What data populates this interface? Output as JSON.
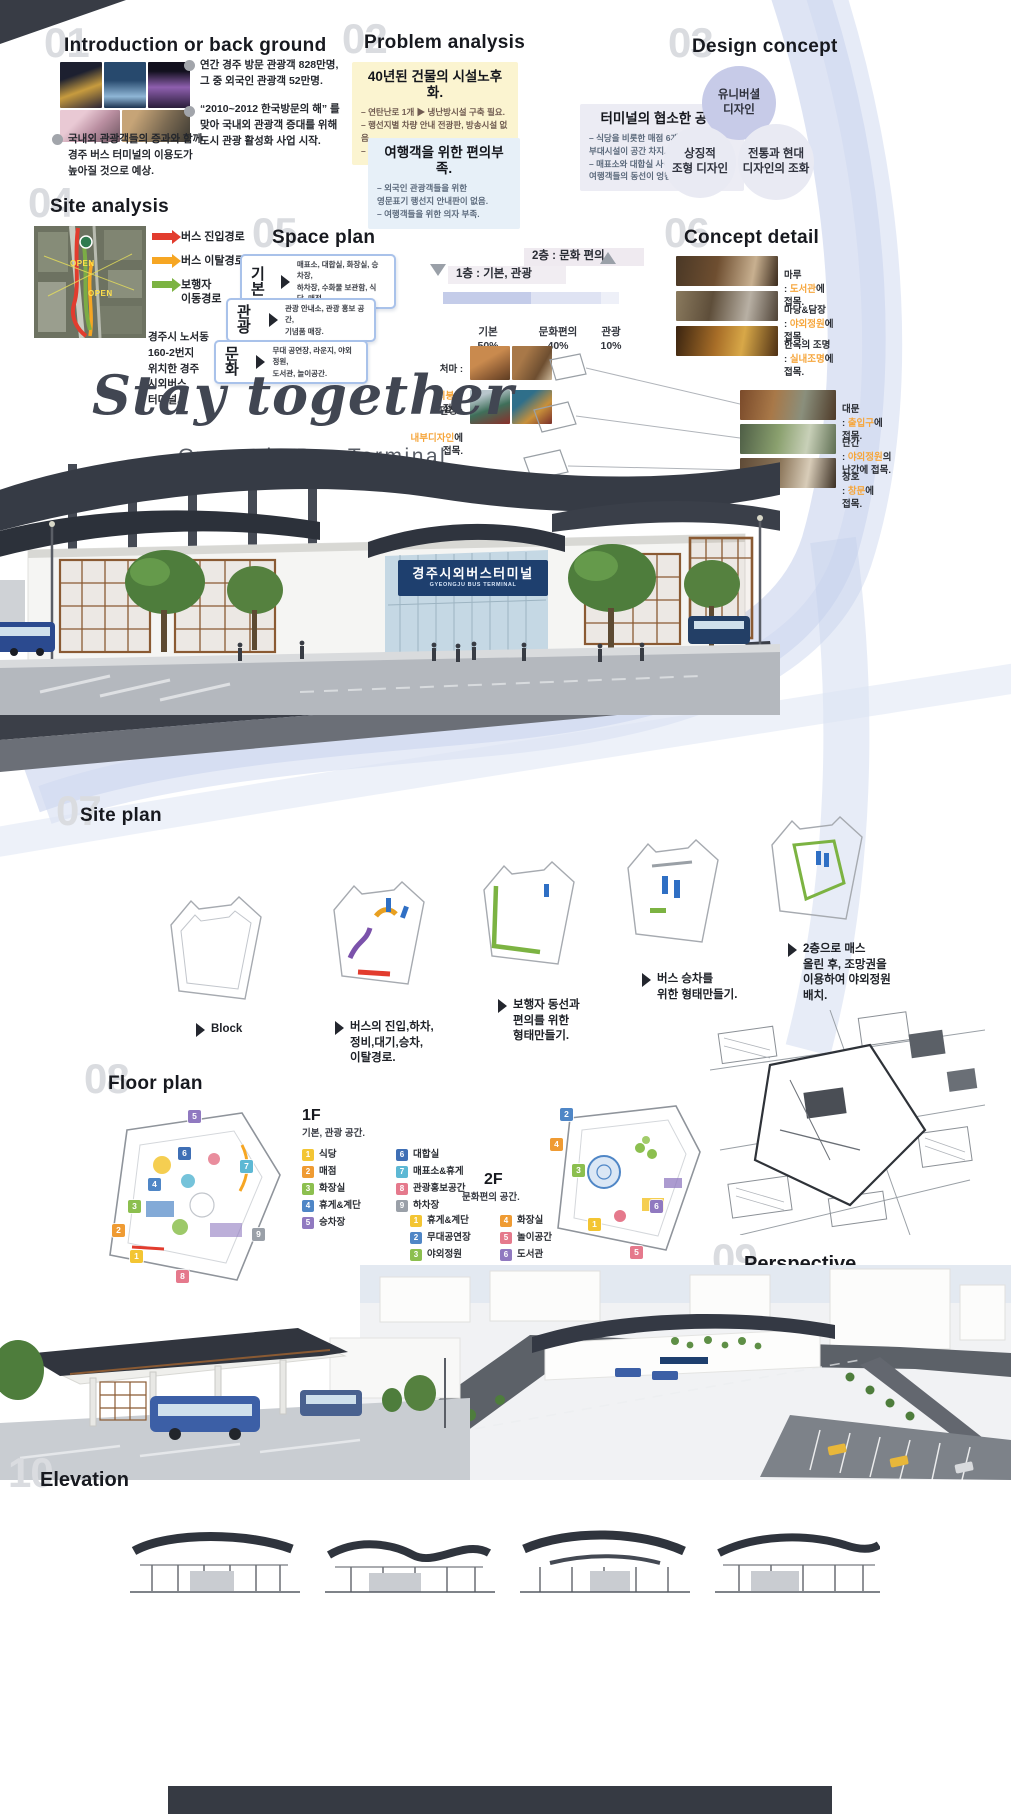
{
  "colors": {
    "hl": "#f6a63c",
    "busin": "#e23c2e",
    "busout": "#f6a623",
    "ped": "#7cb342",
    "sign": "#1e3f6e",
    "navy": "#343944",
    "ribbon": "#b3c2e4",
    "ghost": "#dadce0"
  },
  "s01": {
    "num": "01",
    "title": "Introduction or back ground",
    "notes": [
      "연간 경주 방문 관광객 828만명,\n그 중 외국인 관광객 52만명.",
      "“2010~2012 한국방문의 해” 를\n맞아 국내외 관광객 증대를 위해\n도시 관광 활성화 사업 시작.",
      "국내외 관광객들의 증과와 함께\n경주 버스 터미널의 이용도가\n높아질 것으로 예상."
    ]
  },
  "s02": {
    "num": "02",
    "title": "Problem analysis",
    "boxes": [
      {
        "title": "40년된 건물의 시설노후화.",
        "bullets": [
          "– 연탄난로 1개 ▶ 냉난방시설 구축 필요.",
          "– 행선지별 차량 안내 전광판, 방송시설 없음.",
          "– 방범용 CCTV 없음 ▶ 민생범죄에 취약."
        ]
      },
      {
        "title": "여행객을 위한 편의부족.",
        "bullets": [
          "– 외국인 관광객들을 위한\n   영문표기 행선지 안내판이 없음.",
          "– 여행객들을 위한 의자 부족."
        ]
      },
      {
        "title": "터미널의 협소한 공간.",
        "bullets": [
          "– 식당을 비롯한 매점 6개소와\n   부대시설이 공간 차지.",
          "– 매표소와 대합실 사이\n   여행객들의 동선이 엉킴."
        ]
      }
    ]
  },
  "s03": {
    "num": "03",
    "title": "Design concept",
    "circles": [
      "유니버셜\n디자인",
      "상징적\n조형 디자인",
      "전통과 현대\n디자인의 조화"
    ]
  },
  "s04": {
    "num": "04",
    "title": "Site analysis",
    "legend": [
      {
        "label": "버스 진입경로"
      },
      {
        "label": "버스 이탈경로"
      },
      {
        "label": "보행자\n이동경로"
      }
    ],
    "map_labels": [
      "OPEN",
      "OPEN"
    ],
    "location": "경주시 노서동\n160-2번지\n위치한 경주\n시외버스\n터미널."
  },
  "s05": {
    "num": "05",
    "title": "Space plan",
    "rows": [
      {
        "name": "기본",
        "desc": "매표소, 대합실, 화장실, 승차장,\n하차장, 수화물 보관함, 식당, 매점."
      },
      {
        "name": "관광",
        "desc": "관광 안내소, 관광 홍보 공간,\n기념품 매장."
      },
      {
        "name": "문화",
        "desc": "무대 공연장, 라운지, 야외정원,\n도서관, 놀이공간."
      }
    ],
    "diagram": {
      "floor1": "1층 : 기본, 관광",
      "floor2": "2층 : 문화 편의",
      "segments": [
        {
          "label": "기본",
          "pct": "50%"
        },
        {
          "label": "문화편의",
          "pct": "40%"
        },
        {
          "label": "관광",
          "pct": "10%"
        }
      ]
    },
    "notes": [
      {
        "term": "처마 :",
        "link": "지붕",
        "tail": "에\n접목."
      },
      {
        "term": "단청 :",
        "link": "내부디자인",
        "tail": "에\n접목."
      }
    ]
  },
  "s06": {
    "num": "06",
    "title": "Concept detail",
    "items": [
      {
        "term": "마루",
        "prefix": ": ",
        "link": "도서관",
        "tail": "에\n접목."
      },
      {
        "term": "마당&담장",
        "prefix": ": ",
        "link": "야외정원",
        "tail": "에\n접목."
      },
      {
        "term": "한옥의 조명",
        "prefix": ": ",
        "link": "실내조명",
        "tail": "에\n접목."
      },
      {
        "term": "대문",
        "prefix": ": ",
        "link": "출입구",
        "tail": "에\n접목."
      },
      {
        "term": "난간",
        "prefix": ": ",
        "link": "야외정원",
        "tail": "의\n난간에 접목."
      },
      {
        "term": "창호",
        "prefix": ": ",
        "link": "창문",
        "tail": "에\n접목."
      }
    ]
  },
  "hero": {
    "title": "Stay together",
    "subtitle": "Gyeongju Bus Terminal",
    "sign_ko": "경주시외버스터미널",
    "sign_en": "GYEONGJU BUS TERMINAL"
  },
  "s07": {
    "num": "07",
    "title": "Site plan",
    "steps": [
      {
        "caption": "Block"
      },
      {
        "caption": "버스의 진입,하차,\n정비,대기,승차,\n이탈경로."
      },
      {
        "caption": "보행자 동선과\n편의를 위한\n형태만들기."
      },
      {
        "caption": "버스 승차를\n위한 형태만들기."
      },
      {
        "caption": "2층으로 매스\n올린 후, 조망권을\n이용하여 야외정원\n배치."
      }
    ]
  },
  "s08": {
    "num": "08",
    "title": "Floor plan",
    "f1": {
      "label": "1F",
      "subtitle": "기본, 관광 공간.",
      "items": [
        {
          "n": "1",
          "label": "식당",
          "color": "#f3c533"
        },
        {
          "n": "2",
          "label": "매점",
          "color": "#ef9b33"
        },
        {
          "n": "3",
          "label": "화장실",
          "color": "#8cbf4f"
        },
        {
          "n": "4",
          "label": "휴게&계단",
          "color": "#4f86c6"
        },
        {
          "n": "5",
          "label": "승차장",
          "color": "#9079c0"
        },
        {
          "n": "6",
          "label": "대합실",
          "color": "#3f6fb5"
        },
        {
          "n": "7",
          "label": "매표소&휴게",
          "color": "#5db8d4"
        },
        {
          "n": "8",
          "label": "관광홍보공간",
          "color": "#e5798c"
        },
        {
          "n": "9",
          "label": "하차장",
          "color": "#9aa0a8"
        }
      ]
    },
    "f2": {
      "label": "2F",
      "subtitle": "문화편의 공간.",
      "items": [
        {
          "n": "1",
          "label": "휴게&계단",
          "color": "#f3c533"
        },
        {
          "n": "2",
          "label": "무대공연장",
          "color": "#4f86c6"
        },
        {
          "n": "3",
          "label": "야외정원",
          "color": "#8cbf4f"
        },
        {
          "n": "4",
          "label": "화장실",
          "color": "#ef9b33"
        },
        {
          "n": "5",
          "label": "놀이공간",
          "color": "#e5798c"
        },
        {
          "n": "6",
          "label": "도서관",
          "color": "#9079c0"
        }
      ]
    }
  },
  "s09": {
    "num": "09",
    "title": "Perspective"
  },
  "s10": {
    "num": "10",
    "title": "Elevation"
  }
}
